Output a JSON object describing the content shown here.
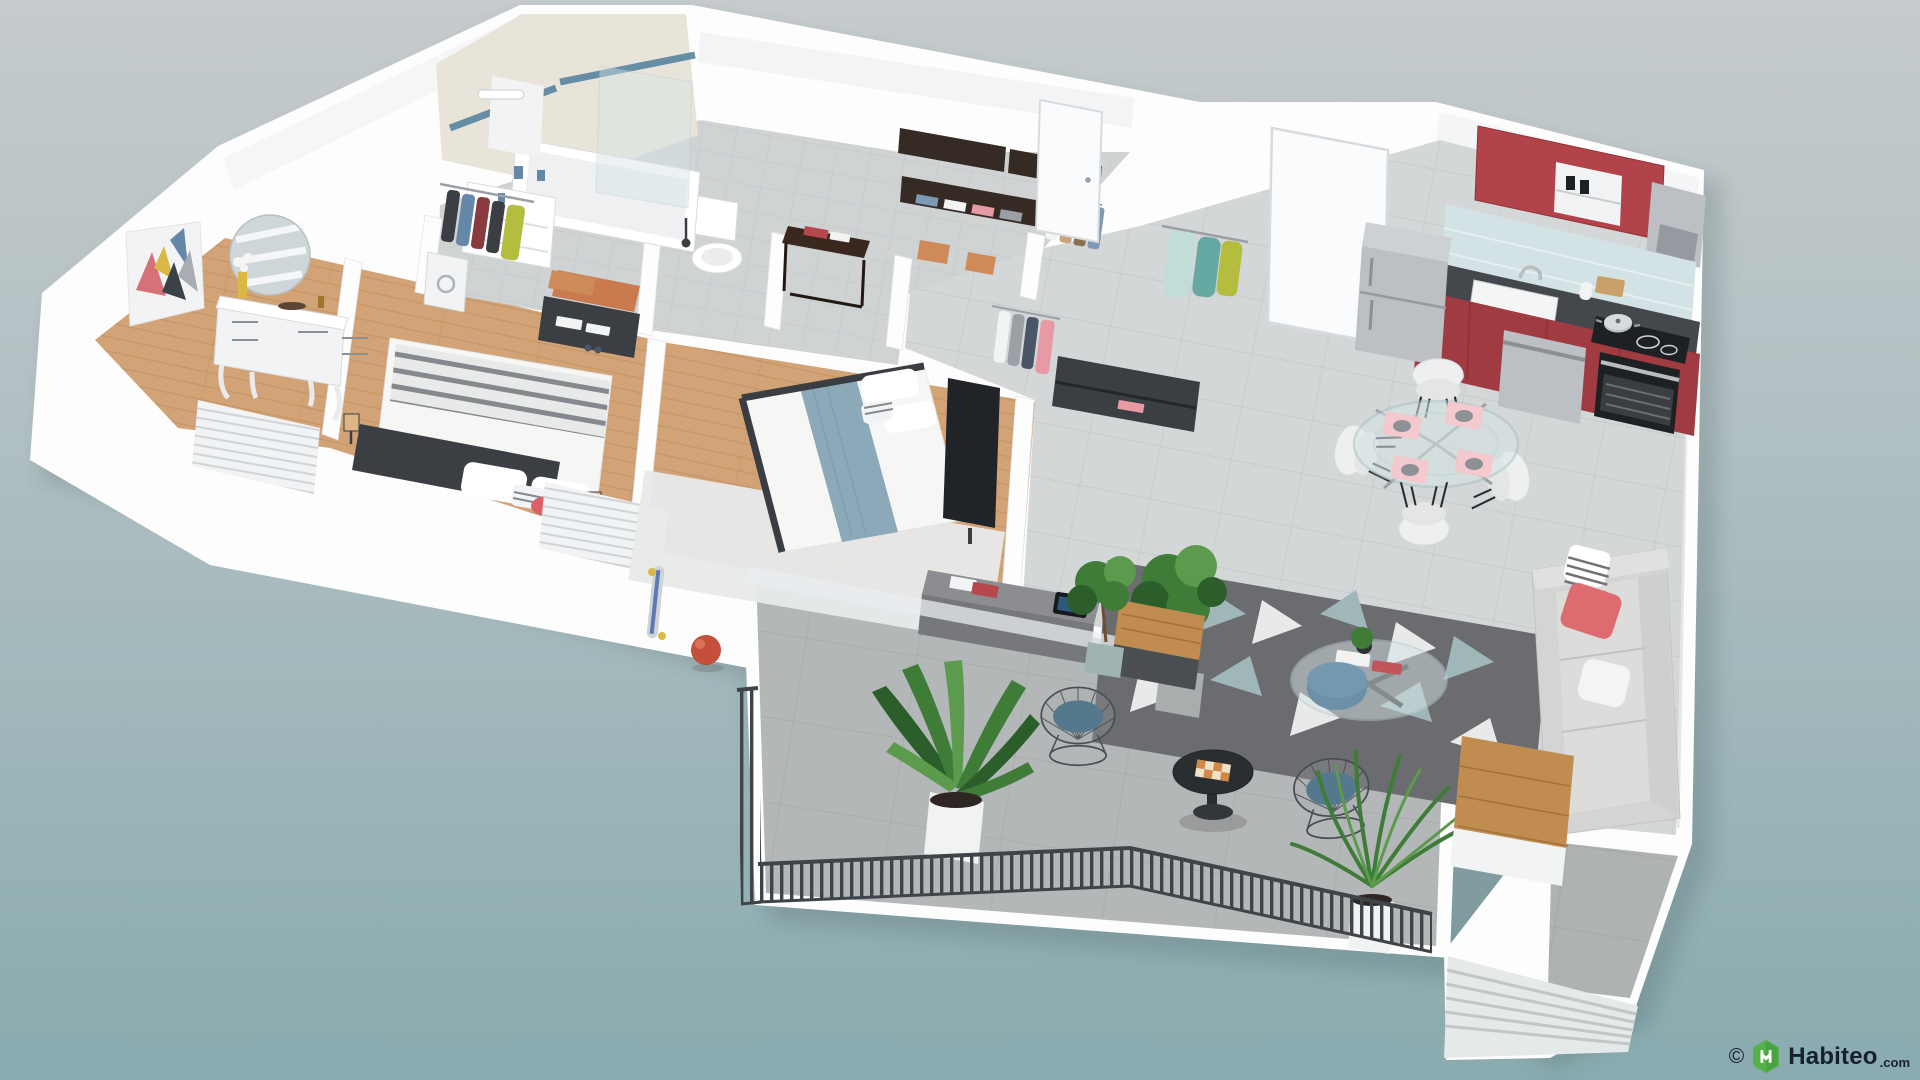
{
  "watermark": {
    "copyright": "©",
    "brand": "Habiteo",
    "suffix": ".com"
  },
  "icons": {
    "logo": "habiteo-hexagon-logo"
  },
  "colors": {
    "bg_top": "#c6cbcd",
    "bg_bottom": "#89abaf",
    "shadow": "#1d3236",
    "wall": "#fdfdfd",
    "wall_shade": "#ebedef",
    "wall_edge": "#dfe2e4",
    "wood": "#d2a376",
    "wood_line": "#b88a58",
    "tile_bath": "#cfd3d4",
    "tile_marble": "#d4d7d8",
    "tile_grout": "#b4b8b9",
    "terrace_floor": "#b4b7b8",
    "patio_floor": "#aeb2b3",
    "step_light": "#e6e9ea",
    "step_dark": "#c2c6c7",
    "rail": "#3f4449",
    "beige_wall": "#e9e4d9",
    "stripe_blue": "#4e7f9b",
    "kitchen_red": "#b2434a",
    "kitchen_red_dark": "#a03b42",
    "backsplash": "#d3e2e4",
    "counter": "#44484c",
    "steel": "#bcc0c4",
    "steel_dark": "#9599a0",
    "appliance_black": "#1e2124",
    "door_white": "#fafbfc",
    "furniture_dark": "#3b3f44",
    "wenge": "#362b24",
    "brown_table": "#3a281e",
    "blanket_stripe": "#85898d",
    "blanket_blue": "#8ca9b9",
    "duvet": "#f6f6f4",
    "pillow_coral": "#d96066",
    "accent_coral": "#dd6b70",
    "pouf_blue": "#6b90a8",
    "cushion_blue": "#54788c",
    "rug_dark": "#6b6c70",
    "rug_light": "#e8eaea",
    "rug_teal": "#9fb7b9",
    "plant_green": "#3e7c38",
    "plant_green_dark": "#2c5e2c",
    "plant_green_light": "#5c9a4e",
    "pot_white": "#f1f2f2",
    "pot_gray": "#a9adae",
    "orange_mat": "#c97a4e",
    "box_tan": "#cf8a5a",
    "art_coral": "#d77178",
    "art_yellow": "#d9b844",
    "art_blue": "#6587a8",
    "art_gray": "#a7adb3",
    "art_dark": "#3b4148",
    "coat_lightblue": "#c2dcd8",
    "coat_teal": "#66a9a2",
    "coat_lime": "#b5bd3e",
    "cloth_navy": "#4a5668",
    "cloth_pink": "#e79aa4",
    "cloth_gray": "#9aa0a6",
    "glass": "#d7e4e6",
    "wood_bar": "#c08c4f",
    "wood_bar_line": "#a5713c",
    "ball_red": "#c4503c",
    "placemat_pink": "#f3c9cd",
    "plate_gray": "#8d9196",
    "logo_green": "#57b14a",
    "logo_green_dark": "#3f9a3e",
    "text_dark": "#17202e"
  }
}
